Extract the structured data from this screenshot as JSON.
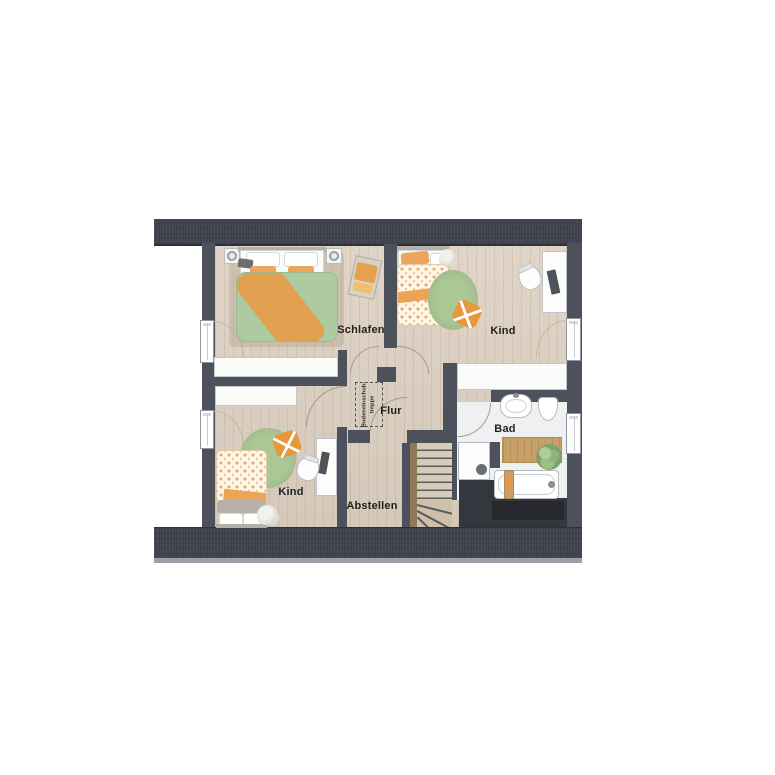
{
  "rooms": {
    "schlafen": {
      "label": "Schlafen"
    },
    "kind_top": {
      "label": "Kind"
    },
    "kind_bottom": {
      "label": "Kind"
    },
    "flur": {
      "label": "Flur"
    },
    "abstellen": {
      "label": "Abstellen"
    },
    "bad": {
      "label": "Bad"
    }
  },
  "annotations": {
    "attic_hatch": {
      "line1": "Bodeneinschub-",
      "line2": "treppe"
    }
  },
  "colors": {
    "roof_band": "#3f434e",
    "wall": "#4d515b",
    "floor_wood": "#dccfc0",
    "floor_bath": "#eef0f1",
    "accent_orange": "#e8a24d",
    "duvet_green": "#aecaa1",
    "rug_green": "#abc795",
    "void_dark": "#34373e"
  }
}
